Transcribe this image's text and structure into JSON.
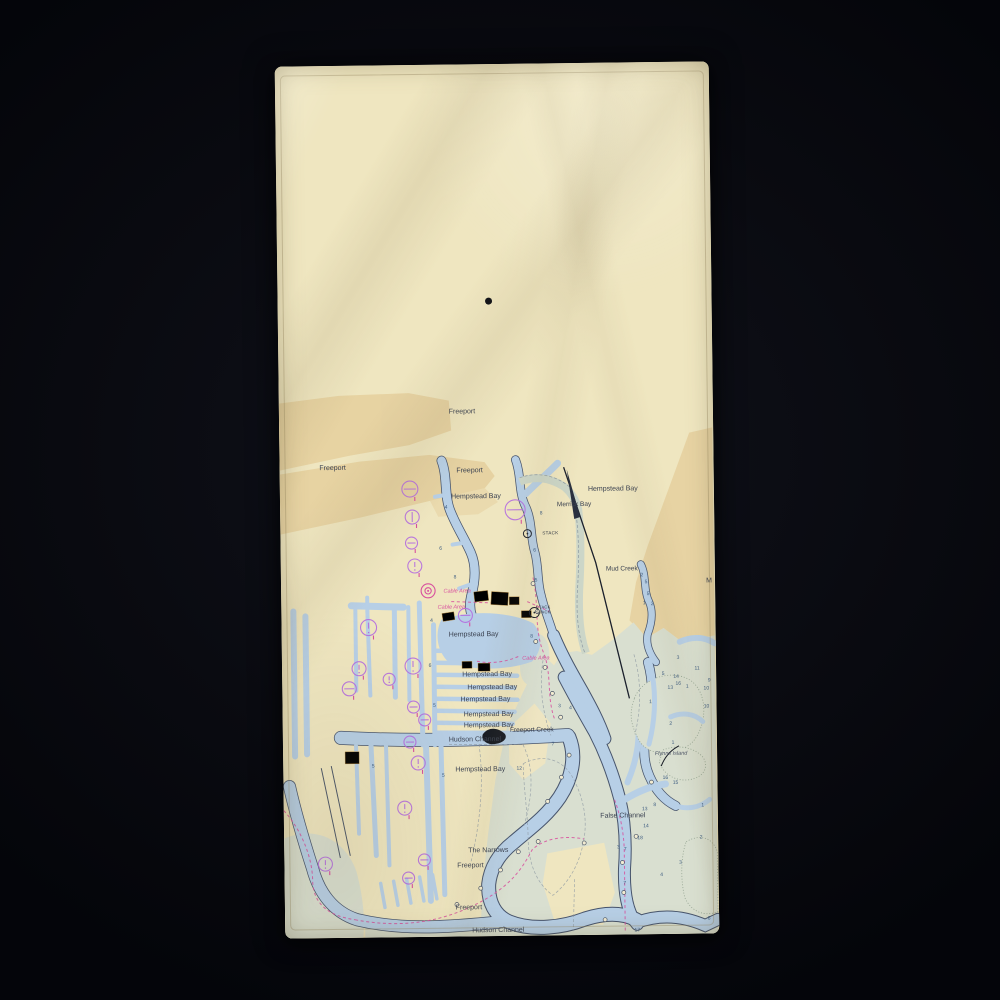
{
  "scene": {
    "background_color": "#0a0b11",
    "product": "beach towel photographed on dark background",
    "towel_color": "#ece3bd"
  },
  "chart": {
    "colors": {
      "land": "#efe6c0",
      "tan": "#e5cf9d",
      "marsh": "#d9dfd0",
      "water": "#b7cfe6",
      "shore": "#46536b",
      "pale": "#ccd6c8",
      "magenta": "#d8509e",
      "purple": "#b46be0",
      "ink": "#3a4150",
      "depth": "#3d5c80",
      "building": "#e2af63",
      "dot": "#0c0e15"
    },
    "place_labels": [
      {
        "t": "Freeport",
        "x": 183,
        "y": 349,
        "s": 7,
        "c": "place"
      },
      {
        "t": "Freeport",
        "x": 53,
        "y": 404,
        "s": 7,
        "c": "place"
      },
      {
        "t": "Freeport",
        "x": 190,
        "y": 408,
        "s": 7,
        "c": "place"
      },
      {
        "t": "Hempstead Bay",
        "x": 196,
        "y": 434,
        "s": 7,
        "c": "place"
      },
      {
        "t": "Hempstead Bay",
        "x": 333,
        "y": 428,
        "s": 7,
        "c": "place"
      },
      {
        "t": "Merrick Bay",
        "x": 294,
        "y": 443,
        "s": 6.5,
        "c": "place"
      },
      {
        "t": "STACK",
        "x": 270,
        "y": 471,
        "s": 4.5,
        "c": "tiny"
      },
      {
        "t": "Mud Creek",
        "x": 341,
        "y": 508,
        "s": 6.5,
        "c": "place"
      },
      {
        "t": "Cable Area",
        "x": 176,
        "y": 528,
        "s": 5.5,
        "c": "mag"
      },
      {
        "t": "Cable Area",
        "x": 170,
        "y": 544,
        "s": 5.5,
        "c": "mag"
      },
      {
        "t": "STACK",
        "x": 262,
        "y": 545,
        "s": 4,
        "c": "tiny"
      },
      {
        "t": "STACK",
        "x": 262,
        "y": 550,
        "s": 4,
        "c": "tiny"
      },
      {
        "t": "Cable Area",
        "x": 254,
        "y": 596,
        "s": 5.5,
        "c": "mag"
      },
      {
        "t": "Hempstead Bay",
        "x": 192,
        "y": 572,
        "s": 7,
        "c": "place"
      },
      {
        "t": "Hempstead Bay",
        "x": 205,
        "y": 612,
        "s": 7,
        "c": "place"
      },
      {
        "t": "Hempstead Bay",
        "x": 210,
        "y": 625,
        "s": 7,
        "c": "place"
      },
      {
        "t": "Hempstead Bay",
        "x": 203,
        "y": 637,
        "s": 7,
        "c": "place"
      },
      {
        "t": "Hempstead Bay",
        "x": 206,
        "y": 652,
        "s": 7,
        "c": "place"
      },
      {
        "t": "Hempstead Bay",
        "x": 206,
        "y": 663,
        "s": 7,
        "c": "place"
      },
      {
        "t": "Freeport Creek",
        "x": 249,
        "y": 668,
        "s": 6.5,
        "c": "place"
      },
      {
        "t": "Hudson Channel",
        "x": 192,
        "y": 677,
        "s": 7,
        "c": "place"
      },
      {
        "t": "Hempstead Bay",
        "x": 197,
        "y": 707,
        "s": 7,
        "c": "place"
      },
      {
        "t": "False Channel",
        "x": 339,
        "y": 755,
        "s": 7,
        "c": "place"
      },
      {
        "t": "Flynns Island",
        "x": 388,
        "y": 693,
        "s": 5.5,
        "c": "island"
      },
      {
        "t": "The Narrows",
        "x": 204,
        "y": 788,
        "s": 7,
        "c": "place"
      },
      {
        "t": "Freeport",
        "x": 186,
        "y": 803,
        "s": 7,
        "c": "place"
      },
      {
        "t": "Freeport",
        "x": 184,
        "y": 845,
        "s": 7,
        "c": "place"
      },
      {
        "t": "Hudson Channel",
        "x": 213,
        "y": 868,
        "s": 7,
        "c": "place"
      },
      {
        "t": "M",
        "x": 428,
        "y": 521,
        "s": 7,
        "c": "place"
      }
    ],
    "depth_numbers": [
      {
        "t": "4",
        "x": 166,
        "y": 444
      },
      {
        "t": "6",
        "x": 160,
        "y": 485
      },
      {
        "t": "8",
        "x": 174,
        "y": 514
      },
      {
        "t": "8",
        "x": 261,
        "y": 451
      },
      {
        "t": "6",
        "x": 254,
        "y": 488
      },
      {
        "t": "5",
        "x": 255,
        "y": 518
      },
      {
        "t": "8",
        "x": 250,
        "y": 574
      },
      {
        "t": "2",
        "x": 361,
        "y": 514
      },
      {
        "t": "5",
        "x": 365,
        "y": 521
      },
      {
        "t": "5",
        "x": 367,
        "y": 533
      },
      {
        "t": "1",
        "x": 363,
        "y": 542
      },
      {
        "t": "2",
        "x": 371,
        "y": 543
      },
      {
        "t": "3",
        "x": 396,
        "y": 597
      },
      {
        "t": "5",
        "x": 381,
        "y": 613
      },
      {
        "t": "14",
        "x": 394,
        "y": 616
      },
      {
        "t": "16",
        "x": 396,
        "y": 623
      },
      {
        "t": "13",
        "x": 388,
        "y": 627
      },
      {
        "t": "11",
        "x": 415,
        "y": 608
      },
      {
        "t": "1",
        "x": 405,
        "y": 626
      },
      {
        "t": "10",
        "x": 424,
        "y": 628
      },
      {
        "t": "9",
        "x": 427,
        "y": 620
      },
      {
        "t": "10",
        "x": 424,
        "y": 646
      },
      {
        "t": "1",
        "x": 368,
        "y": 641
      },
      {
        "t": "2",
        "x": 388,
        "y": 663
      },
      {
        "t": "1",
        "x": 390,
        "y": 682
      },
      {
        "t": "7",
        "x": 270,
        "y": 682
      },
      {
        "t": "4",
        "x": 288,
        "y": 646
      },
      {
        "t": "3",
        "x": 277,
        "y": 644
      },
      {
        "t": "16",
        "x": 382,
        "y": 717
      },
      {
        "t": "15",
        "x": 392,
        "y": 722
      },
      {
        "t": "13",
        "x": 361,
        "y": 748
      },
      {
        "t": "8",
        "x": 371,
        "y": 744
      },
      {
        "t": "14",
        "x": 362,
        "y": 765
      },
      {
        "t": "18",
        "x": 356,
        "y": 777
      },
      {
        "t": "7",
        "x": 341,
        "y": 788
      },
      {
        "t": "3",
        "x": 334,
        "y": 786
      },
      {
        "t": "7",
        "x": 340,
        "y": 822
      },
      {
        "t": "1",
        "x": 419,
        "y": 745
      },
      {
        "t": "2",
        "x": 417,
        "y": 777
      },
      {
        "t": "3",
        "x": 396,
        "y": 802
      },
      {
        "t": "4",
        "x": 377,
        "y": 814
      },
      {
        "t": "6",
        "x": 424,
        "y": 858
      },
      {
        "t": "17",
        "x": 352,
        "y": 869
      },
      {
        "t": "4",
        "x": 150,
        "y": 557
      },
      {
        "t": "6",
        "x": 148,
        "y": 602
      },
      {
        "t": "5",
        "x": 152,
        "y": 642
      },
      {
        "t": "5",
        "x": 90,
        "y": 702
      },
      {
        "t": "5",
        "x": 160,
        "y": 712
      },
      {
        "t": "12",
        "x": 236,
        "y": 706
      }
    ],
    "symbols": [
      {
        "k": "dash",
        "x": 130,
        "y": 424,
        "r": 8
      },
      {
        "k": "dash",
        "x": 235,
        "y": 446,
        "r": 10
      },
      {
        "k": "vline",
        "x": 132,
        "y": 452,
        "r": 7
      },
      {
        "k": "dash",
        "x": 131,
        "y": 478,
        "r": 6
      },
      {
        "k": "excl",
        "x": 134,
        "y": 501,
        "r": 7
      },
      {
        "k": "dot2m",
        "x": 147,
        "y": 526,
        "r": 7
      },
      {
        "k": "dash",
        "x": 184,
        "y": 551,
        "r": 7
      },
      {
        "k": "dotb",
        "x": 247,
        "y": 470,
        "r": 4
      },
      {
        "k": "dotb",
        "x": 253,
        "y": 549,
        "r": 5
      },
      {
        "k": "excl",
        "x": 87,
        "y": 562,
        "r": 8
      },
      {
        "k": "excl",
        "x": 131,
        "y": 601,
        "r": 8
      },
      {
        "k": "excl",
        "x": 77,
        "y": 603,
        "r": 7
      },
      {
        "k": "excl",
        "x": 107,
        "y": 614,
        "r": 6
      },
      {
        "k": "dash",
        "x": 67,
        "y": 623,
        "r": 7
      },
      {
        "k": "dash",
        "x": 131,
        "y": 642,
        "r": 6
      },
      {
        "k": "dash",
        "x": 142,
        "y": 655,
        "r": 6
      },
      {
        "k": "dash",
        "x": 127,
        "y": 677,
        "r": 6
      },
      {
        "k": "excl",
        "x": 135,
        "y": 698,
        "r": 7
      },
      {
        "k": "excl",
        "x": 121,
        "y": 743,
        "r": 7
      },
      {
        "k": "excl",
        "x": 41,
        "y": 798,
        "r": 7
      },
      {
        "k": "dash",
        "x": 140,
        "y": 795,
        "r": 6
      },
      {
        "k": "dash",
        "x": 124,
        "y": 813,
        "r": 6
      },
      {
        "k": "ring",
        "x": 252,
        "y": 520,
        "r": 2
      },
      {
        "k": "ring",
        "x": 256,
        "y": 548,
        "r": 2
      },
      {
        "k": "ring",
        "x": 254,
        "y": 578,
        "r": 2
      },
      {
        "k": "ring",
        "x": 263,
        "y": 604,
        "r": 2
      },
      {
        "k": "ring",
        "x": 270,
        "y": 630,
        "r": 2
      },
      {
        "k": "ring",
        "x": 278,
        "y": 654,
        "r": 2
      },
      {
        "k": "ring",
        "x": 172,
        "y": 840,
        "r": 2
      },
      {
        "k": "ring",
        "x": 196,
        "y": 824,
        "r": 2
      },
      {
        "k": "ring",
        "x": 216,
        "y": 806,
        "r": 2
      },
      {
        "k": "ring",
        "x": 234,
        "y": 788,
        "r": 2
      },
      {
        "k": "ring",
        "x": 254,
        "y": 778,
        "r": 2
      },
      {
        "k": "ring",
        "x": 300,
        "y": 780,
        "r": 2
      },
      {
        "k": "ring",
        "x": 338,
        "y": 800,
        "r": 2
      },
      {
        "k": "ring",
        "x": 339,
        "y": 830,
        "r": 2
      },
      {
        "k": "ring",
        "x": 320,
        "y": 857,
        "r": 2
      },
      {
        "k": "ring",
        "x": 286,
        "y": 692,
        "r": 2
      },
      {
        "k": "ring",
        "x": 278,
        "y": 714,
        "r": 2
      },
      {
        "k": "ring",
        "x": 264,
        "y": 738,
        "r": 2
      },
      {
        "k": "ring",
        "x": 352,
        "y": 774,
        "r": 2
      },
      {
        "k": "ring",
        "x": 368,
        "y": 720,
        "r": 2
      }
    ],
    "towel_dot": {
      "x": 211,
      "y": 237,
      "r": 3.5
    }
  }
}
